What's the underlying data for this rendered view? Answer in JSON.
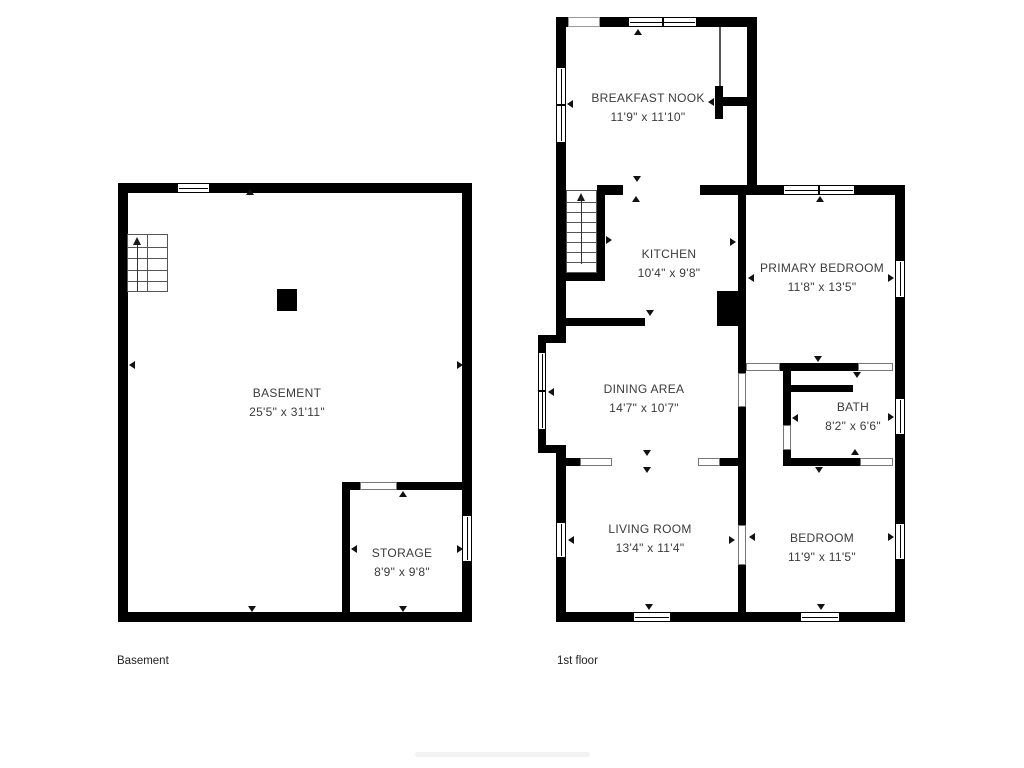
{
  "plans": {
    "basement": {
      "caption": "Basement",
      "rooms": [
        {
          "name": "BASEMENT",
          "dims": "25'5\" x 31'11\""
        },
        {
          "name": "STORAGE",
          "dims": "8'9\" x 9'8\""
        }
      ]
    },
    "first_floor": {
      "caption": "1st floor",
      "rooms": [
        {
          "name": "BREAKFAST NOOK",
          "dims": "11'9\" x 11'10\""
        },
        {
          "name": "KITCHEN",
          "dims": "10'4\" x 9'8\""
        },
        {
          "name": "PRIMARY BEDROOM",
          "dims": "11'8\" x 13'5\""
        },
        {
          "name": "DINING AREA",
          "dims": "14'7\" x 10'7\""
        },
        {
          "name": "BATH",
          "dims": "8'2\" x 6'6\""
        },
        {
          "name": "LIVING ROOM",
          "dims": "13'4\" x 11'4\""
        },
        {
          "name": "BEDROOM",
          "dims": "11'9\" x 11'5\""
        }
      ]
    }
  },
  "colors": {
    "wall": "#000000",
    "text": "#3b3b3b",
    "background": "#ffffff"
  }
}
